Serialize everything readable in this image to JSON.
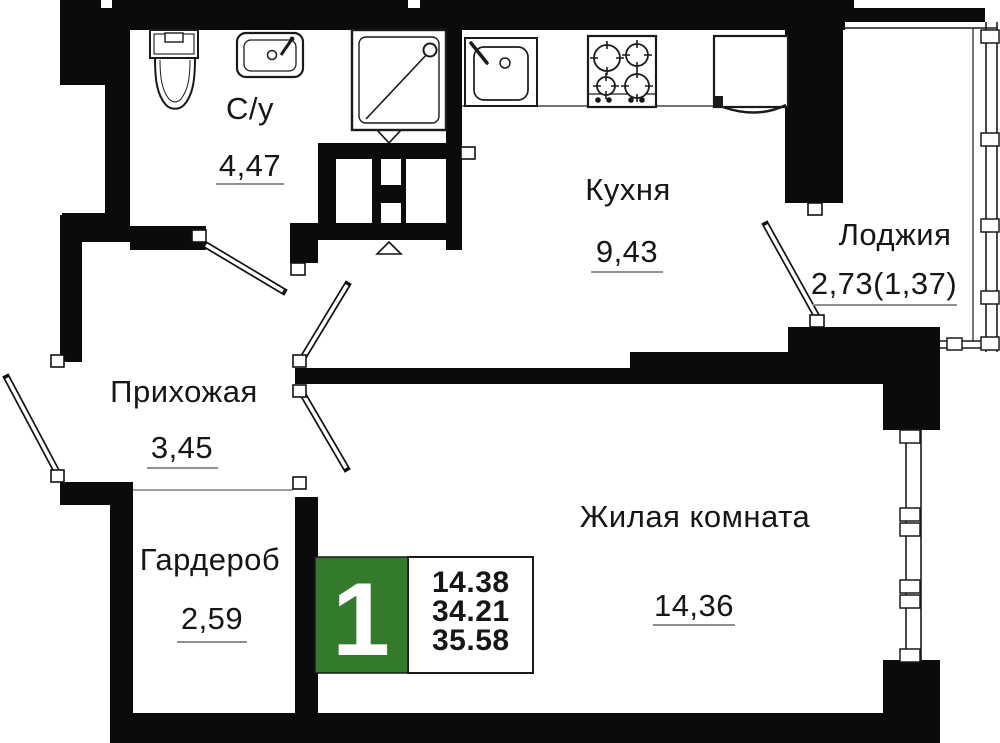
{
  "rooms": [
    {
      "name": "С/у",
      "area": "4,47"
    },
    {
      "name": "Кухня",
      "area": "9,43"
    },
    {
      "name": "Лоджия",
      "area": "2,73(1,37)"
    },
    {
      "name": "Прихожая",
      "area": "3,45"
    },
    {
      "name": "Гардероб",
      "area": "2,59"
    },
    {
      "name": "Жилая комната",
      "area": "14,36"
    }
  ],
  "badge": {
    "rooms_number": "1",
    "area_lines": [
      "14.38",
      "34.21",
      "35.58"
    ]
  },
  "fixtures": [
    "toilet",
    "washbasin",
    "shower",
    "kitchen-sink",
    "stove",
    "fridge"
  ],
  "colors": {
    "walls": "#0b0b0b",
    "badge_green": "#337a2d",
    "underline": "#8f8f8f",
    "text": "#161616",
    "badge_digit": "#ffffff"
  }
}
